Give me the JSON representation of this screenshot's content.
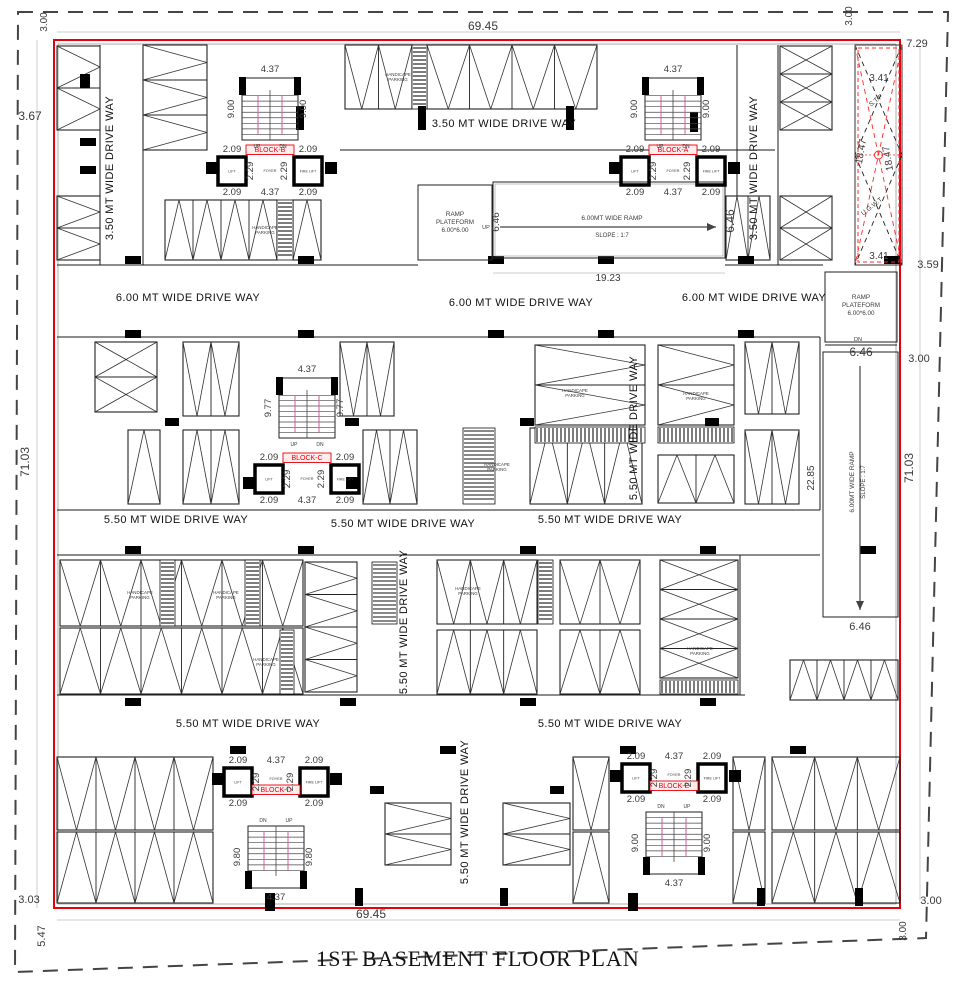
{
  "title": "1ST  BASEMENT FLOOR PLAN",
  "colors": {
    "boundary_red": "#e8000b",
    "red_dash": "#ff2a2a",
    "wall": "#1a1a1a",
    "dim_text": "#3a3a3a",
    "rail_pink": "#cc5f96",
    "inner_gray": "#9a9a9a",
    "dim_line": "#bbbbbb"
  },
  "canvas": {
    "w": 956,
    "h": 988
  },
  "property_line_points": "18,12 948,12 926,938 15,972",
  "building": {
    "x": 54,
    "y": 40,
    "w": 846,
    "h": 868
  },
  "inner_outline": {
    "x": 58,
    "y": 44,
    "w": 838,
    "h": 860
  },
  "stp": {
    "x": 855,
    "y": 45,
    "w": 47,
    "h": 220,
    "label_top": "S.T.P",
    "label_top_xy": [
      877,
      102
    ],
    "label_bottom": "U.G.W.T",
    "label_bottom_xy": [
      873,
      208
    ]
  },
  "dims": [
    [
      "69.45",
      483,
      30,
      0,
      12
    ],
    [
      "3.00",
      47,
      22,
      -90,
      10
    ],
    [
      "3.67",
      30,
      120,
      0,
      12
    ],
    [
      "71.03",
      29,
      462,
      -90,
      12
    ],
    [
      "3.00",
      852,
      16,
      -90,
      10
    ],
    [
      "7.29",
      917,
      47,
      0,
      11
    ],
    [
      "3.41",
      879,
      81,
      0,
      10
    ],
    [
      "18.47",
      864,
      152,
      -80,
      10
    ],
    [
      "18.47",
      891,
      158,
      -100,
      10
    ],
    [
      "3.41",
      879,
      259,
      0,
      10
    ],
    [
      "3.59",
      928,
      268,
      0,
      11
    ],
    [
      "3.00",
      919,
      362,
      0,
      11
    ],
    [
      "71.03",
      913,
      468,
      -90,
      12
    ],
    [
      "22.85",
      814,
      478,
      -90,
      10
    ],
    [
      "19.23",
      608,
      281,
      0,
      10
    ],
    [
      "6.46",
      499,
      222,
      -90,
      10
    ],
    [
      "6.46",
      734,
      221,
      -90,
      12
    ],
    [
      "6.46",
      861,
      356,
      0,
      12
    ],
    [
      "6.46",
      860,
      630,
      0,
      11
    ],
    [
      "69.45",
      371,
      918,
      0,
      12
    ],
    [
      "3.00",
      931,
      904,
      0,
      11
    ],
    [
      "3.00",
      906,
      931,
      -90,
      10
    ],
    [
      "3.03",
      29,
      903,
      0,
      11
    ],
    [
      "5.47",
      45,
      936,
      -90,
      11
    ]
  ],
  "driveway_labels": [
    [
      "3.50 MT WIDE DRIVE WAY",
      113,
      168,
      -90
    ],
    [
      "3.50 MT WIDE DRIVE WAY",
      504,
      127,
      0
    ],
    [
      "3.50 MT WIDE DRIVE WAY",
      757,
      168,
      -90
    ],
    [
      "6.00 MT WIDE DRIVE WAY",
      188,
      301,
      0
    ],
    [
      "6.00 MT WIDE DRIVE WAY",
      521,
      306,
      0
    ],
    [
      "6.00 MT WIDE DRIVE WAY",
      754,
      301,
      0
    ],
    [
      "5.50 MT WIDE DRIVE WAY",
      637,
      428,
      -90
    ],
    [
      "5.50 MT WIDE DRIVE WAY",
      176,
      523,
      0
    ],
    [
      "5.50 MT WIDE DRIVE WAY",
      403,
      527,
      0
    ],
    [
      "5.50 MT WIDE DRIVE WAY",
      610,
      523,
      0
    ],
    [
      "5.50 MT WIDE DRIVE WAY",
      407,
      622,
      -90
    ],
    [
      "5.50 MT WIDE DRIVE WAY",
      248,
      727,
      0
    ],
    [
      "5.50 MT WIDE DRIVE WAY",
      610,
      727,
      0
    ],
    [
      "5.50 MT WIDE DRIVE WAY",
      468,
      812,
      -90
    ]
  ],
  "handicap_label": {
    "line1": "HANDICAPE",
    "line2": "PARKING"
  },
  "handicap_positions": [
    [
      398,
      76
    ],
    [
      265,
      229
    ],
    [
      575,
      392
    ],
    [
      696,
      395
    ],
    [
      497,
      466
    ],
    [
      140,
      594
    ],
    [
      226,
      594
    ],
    [
      266,
      661
    ],
    [
      468,
      590
    ],
    [
      700,
      650
    ]
  ],
  "stall_groups": [
    [
      57,
      46,
      43,
      84,
      2,
      "h",
      "vr"
    ],
    [
      143,
      45,
      64,
      105,
      3,
      "h",
      "vr"
    ],
    [
      345,
      45,
      67,
      64,
      2,
      "v",
      "vd"
    ],
    [
      427,
      45,
      170,
      64,
      4,
      "v",
      "vd"
    ],
    [
      780,
      46,
      52,
      84,
      3,
      "h",
      "x"
    ],
    [
      57,
      196,
      43,
      64,
      2,
      "h",
      "vr"
    ],
    [
      165,
      200,
      112,
      60,
      4,
      "v",
      "vu"
    ],
    [
      293,
      200,
      28,
      60,
      1,
      "v",
      "vu"
    ],
    [
      726,
      196,
      44,
      64,
      2,
      "v",
      "vu"
    ],
    [
      780,
      196,
      52,
      64,
      2,
      "h",
      "x"
    ],
    [
      95,
      342,
      62,
      70,
      2,
      "h",
      "x"
    ],
    [
      183,
      342,
      56,
      74,
      2,
      "v",
      "vd"
    ],
    [
      340,
      342,
      54,
      74,
      2,
      "v",
      "vd"
    ],
    [
      535,
      345,
      110,
      80,
      2,
      "h",
      "vr"
    ],
    [
      658,
      345,
      76,
      80,
      2,
      "h",
      "vr"
    ],
    [
      745,
      342,
      54,
      72,
      2,
      "v",
      "vd"
    ],
    [
      128,
      430,
      32,
      74,
      1,
      "v",
      "vu"
    ],
    [
      183,
      430,
      56,
      74,
      2,
      "v",
      "vu"
    ],
    [
      363,
      430,
      54,
      74,
      2,
      "v",
      "vu"
    ],
    [
      530,
      428,
      112,
      76,
      3,
      "v",
      "vu"
    ],
    [
      658,
      455,
      76,
      48,
      2,
      "v",
      "vu"
    ],
    [
      745,
      430,
      54,
      74,
      2,
      "v",
      "vd"
    ],
    [
      60,
      560,
      243,
      66,
      6,
      "v",
      "vd"
    ],
    [
      60,
      628,
      243,
      66,
      6,
      "v",
      "vu"
    ],
    [
      305,
      562,
      52,
      130,
      4,
      "h",
      "vr"
    ],
    [
      437,
      560,
      100,
      64,
      3,
      "v",
      "vd"
    ],
    [
      560,
      560,
      80,
      64,
      2,
      "v",
      "vd"
    ],
    [
      437,
      630,
      100,
      64,
      3,
      "v",
      "vu"
    ],
    [
      560,
      630,
      80,
      64,
      2,
      "v",
      "vu"
    ],
    [
      660,
      560,
      78,
      118,
      4,
      "h",
      "x"
    ],
    [
      790,
      660,
      108,
      40,
      4,
      "v",
      "vu"
    ],
    [
      57,
      757,
      156,
      73,
      4,
      "v",
      "vd"
    ],
    [
      57,
      832,
      156,
      71,
      4,
      "v",
      "vu"
    ],
    [
      385,
      803,
      66,
      62,
      2,
      "h",
      "vr"
    ],
    [
      503,
      803,
      67,
      62,
      2,
      "h",
      "vr"
    ],
    [
      573,
      757,
      36,
      73,
      1,
      "v",
      "vd"
    ],
    [
      573,
      832,
      36,
      71,
      1,
      "v",
      "vu"
    ],
    [
      733,
      757,
      32,
      73,
      1,
      "v",
      "vd"
    ],
    [
      733,
      832,
      32,
      71,
      1,
      "v",
      "vu"
    ],
    [
      772,
      757,
      128,
      73,
      3,
      "v",
      "vd"
    ],
    [
      772,
      832,
      128,
      71,
      3,
      "v",
      "vu"
    ]
  ],
  "hatches": [
    [
      412,
      45,
      15,
      64
    ],
    [
      277,
      200,
      16,
      60
    ],
    [
      535,
      427,
      110,
      16
    ],
    [
      658,
      427,
      76,
      16
    ],
    [
      463,
      428,
      32,
      76
    ],
    [
      160,
      560,
      15,
      66
    ],
    [
      245,
      560,
      15,
      66
    ],
    [
      280,
      630,
      14,
      64
    ],
    [
      372,
      562,
      25,
      62
    ],
    [
      538,
      560,
      15,
      64
    ],
    [
      660,
      680,
      78,
      14
    ]
  ],
  "columns": [
    [
      296,
      106,
      8,
      24
    ],
    [
      418,
      106,
      8,
      24
    ],
    [
      566,
      106,
      8,
      24
    ],
    [
      690,
      112,
      8,
      20
    ],
    [
      206,
      162,
      12,
      12
    ],
    [
      325,
      162,
      12,
      12
    ],
    [
      609,
      162,
      12,
      12
    ],
    [
      728,
      162,
      12,
      12
    ],
    [
      80,
      74,
      10,
      14
    ],
    [
      80,
      138,
      16,
      8
    ],
    [
      80,
      166,
      16,
      8
    ],
    [
      125,
      256,
      16,
      8
    ],
    [
      298,
      256,
      16,
      8
    ],
    [
      488,
      256,
      16,
      8
    ],
    [
      598,
      256,
      16,
      8
    ],
    [
      738,
      256,
      16,
      8
    ],
    [
      884,
      256,
      16,
      8
    ],
    [
      125,
      330,
      16,
      8
    ],
    [
      298,
      330,
      16,
      8
    ],
    [
      488,
      330,
      16,
      8
    ],
    [
      598,
      330,
      16,
      8
    ],
    [
      738,
      330,
      16,
      8
    ],
    [
      165,
      418,
      14,
      8
    ],
    [
      345,
      418,
      14,
      8
    ],
    [
      520,
      418,
      14,
      8
    ],
    [
      705,
      418,
      14,
      8
    ],
    [
      243,
      477,
      12,
      12
    ],
    [
      346,
      477,
      12,
      12
    ],
    [
      125,
      546,
      16,
      8
    ],
    [
      298,
      546,
      16,
      8
    ],
    [
      520,
      546,
      16,
      8
    ],
    [
      700,
      546,
      16,
      8
    ],
    [
      860,
      546,
      16,
      8
    ],
    [
      125,
      698,
      16,
      8
    ],
    [
      340,
      698,
      16,
      8
    ],
    [
      520,
      698,
      16,
      8
    ],
    [
      700,
      698,
      16,
      8
    ],
    [
      230,
      746,
      16,
      8
    ],
    [
      440,
      746,
      16,
      8
    ],
    [
      620,
      746,
      16,
      8
    ],
    [
      790,
      746,
      16,
      8
    ],
    [
      212,
      773,
      12,
      12
    ],
    [
      330,
      773,
      12,
      12
    ],
    [
      610,
      770,
      12,
      12
    ],
    [
      729,
      770,
      12,
      12
    ],
    [
      370,
      786,
      14,
      8
    ],
    [
      550,
      786,
      14,
      8
    ],
    [
      265,
      893,
      10,
      18
    ],
    [
      355,
      888,
      8,
      18
    ],
    [
      500,
      888,
      8,
      18
    ],
    [
      628,
      893,
      10,
      18
    ],
    [
      757,
      888,
      8,
      18
    ],
    [
      855,
      888,
      8,
      18
    ]
  ],
  "walls": [
    [
      340,
      150,
      775,
      150
    ],
    [
      57,
      265,
      418,
      265
    ],
    [
      725,
      265,
      823,
      265
    ],
    [
      57,
      337,
      820,
      337
    ],
    [
      57,
      510,
      820,
      510
    ],
    [
      57,
      555,
      820,
      555
    ],
    [
      57,
      695,
      745,
      695
    ],
    [
      100,
      45,
      100,
      265
    ],
    [
      143,
      150,
      143,
      265
    ],
    [
      737,
      45,
      737,
      196
    ],
    [
      778,
      45,
      778,
      265
    ],
    [
      855,
      265,
      902,
      265
    ],
    [
      820,
      337,
      820,
      510
    ],
    [
      740,
      555,
      740,
      695
    ]
  ],
  "dim_lines": [
    [
      57,
      32,
      900,
      32
    ],
    [
      57,
      920,
      900,
      920
    ],
    [
      37,
      40,
      37,
      908
    ],
    [
      920,
      46,
      920,
      900
    ],
    [
      493,
      273,
      725,
      273
    ]
  ],
  "stair_text": {
    "up": "UP",
    "dn": "DN",
    "lift": "LIFT",
    "fire_lift": "FIRE LIFT",
    "foyer": "FOYER"
  },
  "block_dims": {
    "d209": "2.09",
    "d229": "2.29",
    "d437": "4.37"
  },
  "blocks": [
    {
      "name": "BLOCK-B",
      "cx": 270,
      "type": "up",
      "stair": [
        242,
        78,
        56,
        62
      ],
      "liftL": [
        218,
        157,
        28,
        28
      ],
      "liftR": [
        294,
        157,
        28,
        28
      ],
      "side": "9.00"
    },
    {
      "name": "BLOCK-A",
      "cx": 673,
      "type": "up",
      "stair": [
        645,
        78,
        56,
        62
      ],
      "liftL": [
        621,
        157,
        28,
        28
      ],
      "liftR": [
        697,
        157,
        28,
        28
      ],
      "side": "9.00"
    },
    {
      "name": "BLOCK-C",
      "cx": 307,
      "type": "up",
      "stair": [
        279,
        378,
        56,
        60
      ],
      "liftL": [
        255,
        465,
        28,
        28
      ],
      "liftR": [
        331,
        465,
        28,
        28
      ],
      "side": "9.77"
    },
    {
      "name": "BLOCK-D",
      "cx": 276,
      "type": "down",
      "stair": [
        248,
        826,
        56,
        62
      ],
      "liftL": [
        224,
        768,
        28,
        28
      ],
      "liftR": [
        300,
        768,
        28,
        28
      ],
      "side": "9.80"
    },
    {
      "name": "BLOCK-E",
      "cx": 674,
      "type": "down",
      "stair": [
        646,
        812,
        56,
        62
      ],
      "liftL": [
        622,
        764,
        28,
        28
      ],
      "liftR": [
        698,
        764,
        28,
        28
      ],
      "side": "9.00"
    }
  ],
  "ramp_center": {
    "platform": [
      418,
      185,
      74,
      75
    ],
    "platform_text": [
      "RAMP",
      "PLATEFORM",
      "6.00*6.00"
    ],
    "corridor": [
      493,
      182,
      232,
      76
    ],
    "up": "UP",
    "up_xy": [
      486,
      229
    ],
    "arrow": [
      500,
      227,
      716,
      227
    ],
    "label": "6.00MT WIDE RAMP",
    "label_xy": [
      612,
      220
    ],
    "slope": "SLOPE : 1:7",
    "slope_xy": [
      612,
      231
    ]
  },
  "ramp_right": {
    "platform": [
      825,
      272,
      72,
      70
    ],
    "platform_text": [
      "RAMP",
      "PLATEFORM",
      "6.00*6.00"
    ],
    "dn": "DN",
    "dn_xy": [
      858,
      341
    ],
    "divider": [
      825,
      345,
      897,
      345
    ],
    "corridor": [
      823,
      352,
      75,
      265
    ],
    "arrow": [
      860,
      366,
      860,
      610
    ],
    "label": "6.00MT WIDE RAMP",
    "label_xy": [
      854,
      482
    ],
    "slope": "SLOPE : 1:7",
    "slope_xy": [
      865,
      482
    ],
    "bottom_line": [
      823,
      617,
      898,
      617
    ]
  }
}
